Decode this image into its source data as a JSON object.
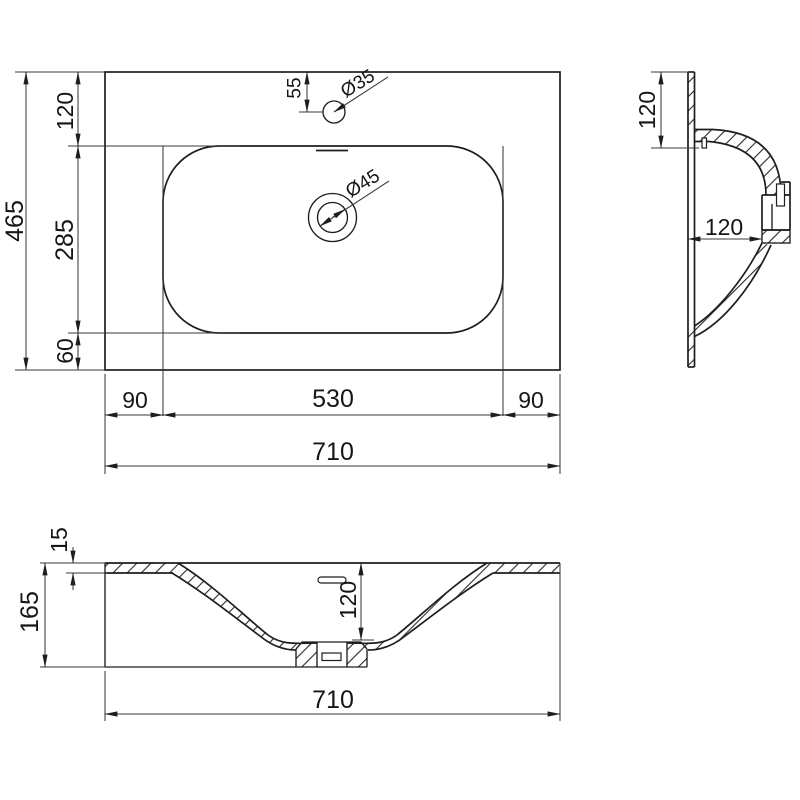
{
  "drawing": {
    "type": "washbasin technical drawing, three orthographic section views",
    "background": "#ffffff",
    "line_color": "#1e1e1e",
    "views": {
      "top_view": {
        "overall_depth": "465",
        "back_margin": "120",
        "basin_depth": "285",
        "front_margin": "60",
        "left_margin": "90",
        "basin_width": "530",
        "right_margin": "90",
        "overall_width": "710",
        "faucet_offset": "55",
        "faucet_hole_dia": "Ø35",
        "drain_dia": "Ø45"
      },
      "side_view": {
        "rim_height": "120",
        "drain_offset": "120"
      },
      "front_view": {
        "edge_thickness": "15",
        "overall_height": "165",
        "bowl_depth": "120",
        "overall_width": "710"
      }
    }
  }
}
